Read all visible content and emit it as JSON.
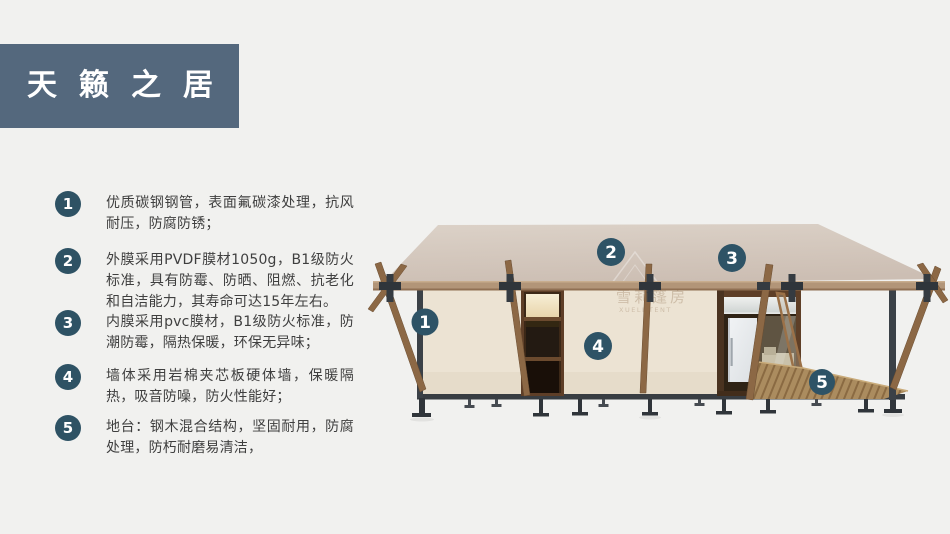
{
  "title": {
    "text": "天籁之居"
  },
  "features": [
    {
      "number": "1",
      "text": "优质碳钢钢管，表面氟碳漆处理，抗风耐压，防腐防锈；"
    },
    {
      "number": "2",
      "text": "外膜采用PVDF膜材1050g，B1级防火标准，具有防霉、防晒、阻燃、抗老化和自洁能力，其寿命可达15年左右。"
    },
    {
      "number": "3",
      "text": "内膜采用pvc膜材，B1级防火标准，防潮防霉，隔热保暖，环保无异味；"
    },
    {
      "number": "4",
      "text": "墙体采用岩棉夹芯板硬体墙，保暖隔热，吸音防噪，防火性能好；"
    },
    {
      "number": "5",
      "text": "地台：钢木混合结构，坚固耐用，防腐处理，防朽耐磨易清洁，"
    }
  ],
  "diagram": {
    "badges": [
      {
        "number": "1"
      },
      {
        "number": "2"
      },
      {
        "number": "3"
      },
      {
        "number": "4"
      },
      {
        "number": "5"
      }
    ],
    "watermark": {
      "text": "雪莉篷房",
      "subtext": "XUELI TENT"
    }
  },
  "colors": {
    "page_bg": "#f1f1ef",
    "banner_bg": "#54687d",
    "badge_bg": "#2e5264",
    "body_text": "#3f3f3f",
    "roof": "#d5cabf",
    "wall": "#ece3d3",
    "wood": "#8c6845",
    "steel": "#3b4147",
    "deck": "#ab8c5f",
    "door_frame": "#5e3e27"
  }
}
